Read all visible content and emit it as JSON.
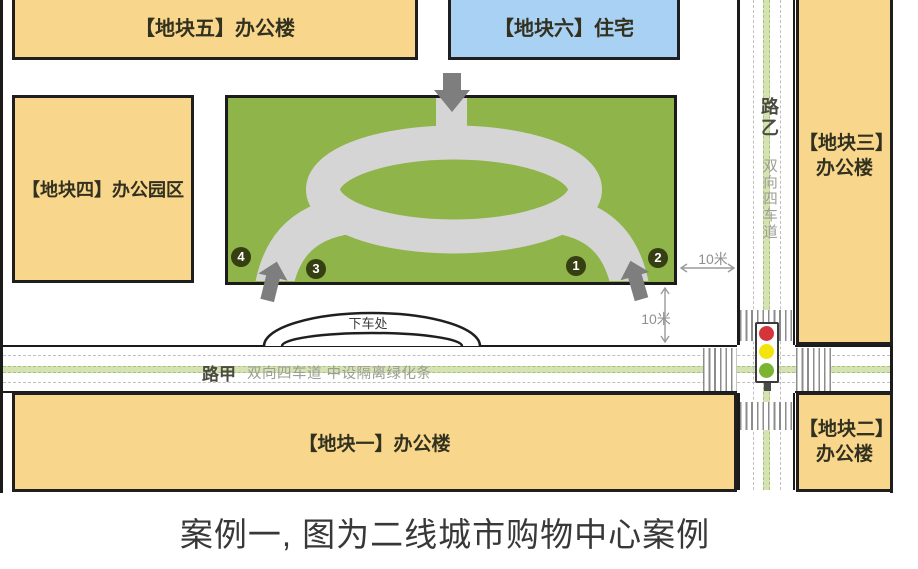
{
  "caption": "案例一, 图为二线城市购物中心案例",
  "plots": {
    "plot1": {
      "label": "【地块一】办公楼"
    },
    "plot2": {
      "label_line1": "【地块二】",
      "label_line2": "办公楼"
    },
    "plot3": {
      "label_line1": "【地块三】",
      "label_line2": "办公楼"
    },
    "plot4": {
      "label": "【地块四】办公园区"
    },
    "plot5": {
      "label": "【地块五】办公楼"
    },
    "plot6": {
      "label": "【地块六】住宅"
    }
  },
  "roads": {
    "road_jia": {
      "name": "路甲",
      "description": "双向四车道 中设隔离绿化条"
    },
    "road_yi": {
      "name": "路乙",
      "description": "双向四车道"
    }
  },
  "site": {
    "dropoff_label": "下车处",
    "entrance_markers": [
      {
        "label": "1"
      },
      {
        "label": "2"
      },
      {
        "label": "3"
      },
      {
        "label": "4"
      }
    ]
  },
  "dimensions": {
    "east_gap": "10米",
    "south_gap": "10米"
  },
  "colors": {
    "office_block_fill": "#F8D78C",
    "residential_fill": "#A9D1F3",
    "site_green": "#8FB44A",
    "internal_road_gray": "#D5D5D5",
    "entrance_arrow_gray": "#7E7E7E",
    "marker_circle": "#353F12",
    "median_green": "#D5E3B3",
    "signal_red": "#D6343B",
    "signal_yellow": "#F2E40C",
    "signal_green": "#7BB433"
  }
}
